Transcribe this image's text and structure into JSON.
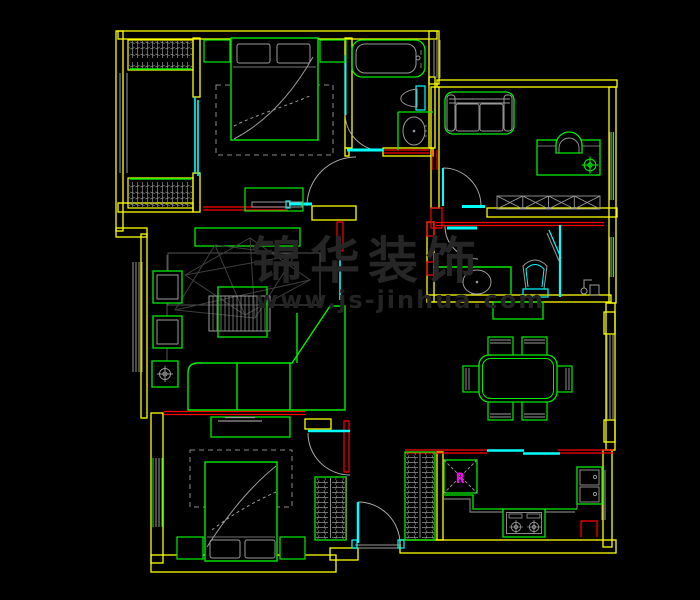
{
  "canvas": {
    "width": 700,
    "height": 600,
    "background": "#000000"
  },
  "watermark": {
    "line1": "锦华装饰",
    "line2": "www.js-jinhua.com"
  },
  "palette": {
    "wall": "#ffff00",
    "furniture": "#00ff00",
    "structure": "#ff0000",
    "wet_glazing": "#00ffff",
    "fixture": "#9a9a9a",
    "frame_dim": "#555555",
    "wireframe": "#3f3f3f",
    "watermark": "#262626",
    "marker": "#ff00ff",
    "background": "#000000"
  },
  "kitchen": {
    "fridge_marker": "R"
  },
  "rooms": [
    "wardrobe-balcony",
    "bedroom-top",
    "bathroom-top",
    "study",
    "bathroom-right",
    "hallway",
    "living-room",
    "dining-area",
    "bedroom-bottom",
    "entry",
    "kitchen"
  ]
}
